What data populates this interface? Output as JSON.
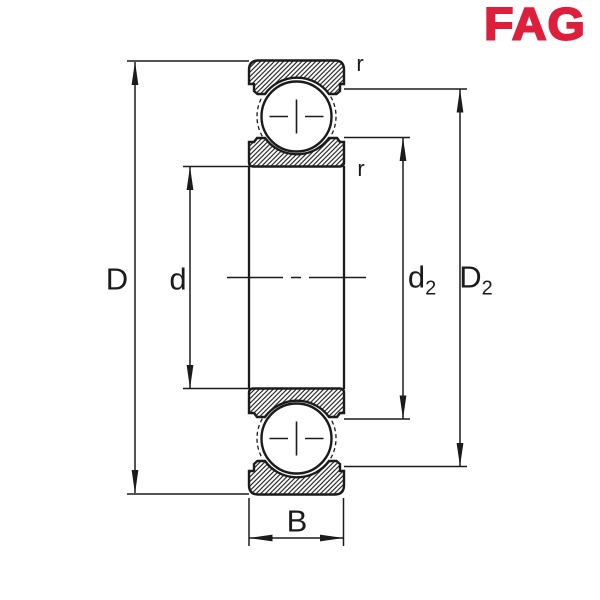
{
  "brand": {
    "name": "FAG",
    "color": "#DE1F3C"
  },
  "drawing": {
    "line_color": "#1B1B1B",
    "labels": {
      "outer_diameter": "D",
      "bore_diameter": "d",
      "inner_shoulder_base": "d",
      "inner_shoulder_sub": "2",
      "outer_shoulder_base": "D",
      "outer_shoulder_sub": "2",
      "width": "B",
      "radius_top": "r",
      "radius_bottom": "r"
    }
  }
}
